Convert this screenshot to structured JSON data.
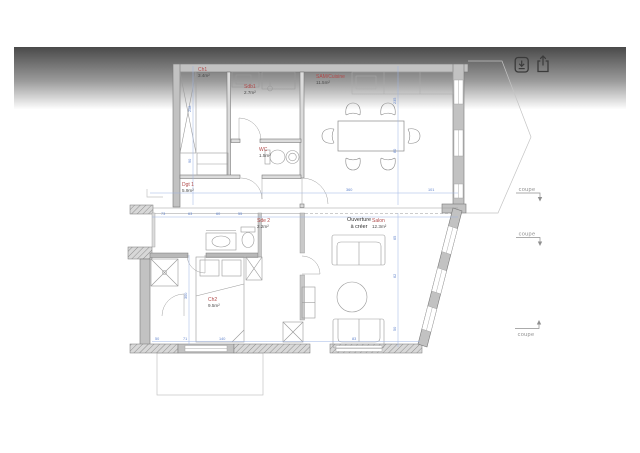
{
  "toolbar": {
    "icons": [
      {
        "name": "download-icon"
      },
      {
        "name": "share-icon"
      }
    ]
  },
  "plan": {
    "rooms": [
      {
        "name": "Ch1",
        "area": "3.4m²",
        "x": 198,
        "y": 71
      },
      {
        "name": "Sdb1",
        "area": "2.7m²",
        "x": 244,
        "y": 88
      },
      {
        "name": "WC",
        "area": "1.5m²",
        "x": 259,
        "y": 151
      },
      {
        "name": "SAM/Cuisine",
        "area": "11.5m²",
        "x": 316,
        "y": 78
      },
      {
        "name": "Dgt 1",
        "area": "5.9m²",
        "x": 182,
        "y": 186
      },
      {
        "name": "Sde 2",
        "area": "2.2m²",
        "x": 257,
        "y": 222
      },
      {
        "name": "Ch2",
        "area": "9.5m²",
        "x": 208,
        "y": 301
      },
      {
        "name": "Salon",
        "area": "12.3m²",
        "x": 372,
        "y": 222
      }
    ],
    "annotation": {
      "line1": "Ouverture",
      "line2": "à créer"
    },
    "coupe_labels": [
      "coupe",
      "coupe",
      "coupe"
    ],
    "dimensions": [
      {
        "v": "258",
        "x": 191,
        "y": 112,
        "r": -90
      },
      {
        "v": "90",
        "x": 191,
        "y": 163,
        "r": -90
      },
      {
        "v": "235",
        "x": 396,
        "y": 104,
        "r": -90
      },
      {
        "v": "80",
        "x": 396,
        "y": 153,
        "r": -90
      },
      {
        "v": "360",
        "x": 346,
        "y": 191,
        "r": 0
      },
      {
        "v": "101",
        "x": 428,
        "y": 191,
        "r": 0
      },
      {
        "v": "73",
        "x": 161,
        "y": 215,
        "r": 0
      },
      {
        "v": "63",
        "x": 188,
        "y": 215,
        "r": 0
      },
      {
        "v": "60",
        "x": 216,
        "y": 215,
        "r": 0
      },
      {
        "v": "55",
        "x": 238,
        "y": 215,
        "r": 0
      },
      {
        "v": "300",
        "x": 187,
        "y": 299,
        "r": -90
      },
      {
        "v": "65",
        "x": 396,
        "y": 240,
        "r": -90
      },
      {
        "v": "62",
        "x": 396,
        "y": 278,
        "r": -90
      },
      {
        "v": "50",
        "x": 396,
        "y": 331,
        "r": -90
      },
      {
        "v": "50",
        "x": 155,
        "y": 340,
        "r": 0
      },
      {
        "v": "71",
        "x": 183,
        "y": 340,
        "r": 0
      },
      {
        "v": "140",
        "x": 219,
        "y": 340,
        "r": 0
      },
      {
        "v": "83",
        "x": 352,
        "y": 340,
        "r": 0
      }
    ],
    "colors": {
      "wall_fill": "#c2c2c2",
      "wall_stroke": "#787878",
      "dimension": "#5f82cc",
      "room_label": "#b04a4a",
      "annotation_text": "#2e2e2e",
      "fade_top": "#4a4a4a"
    }
  }
}
